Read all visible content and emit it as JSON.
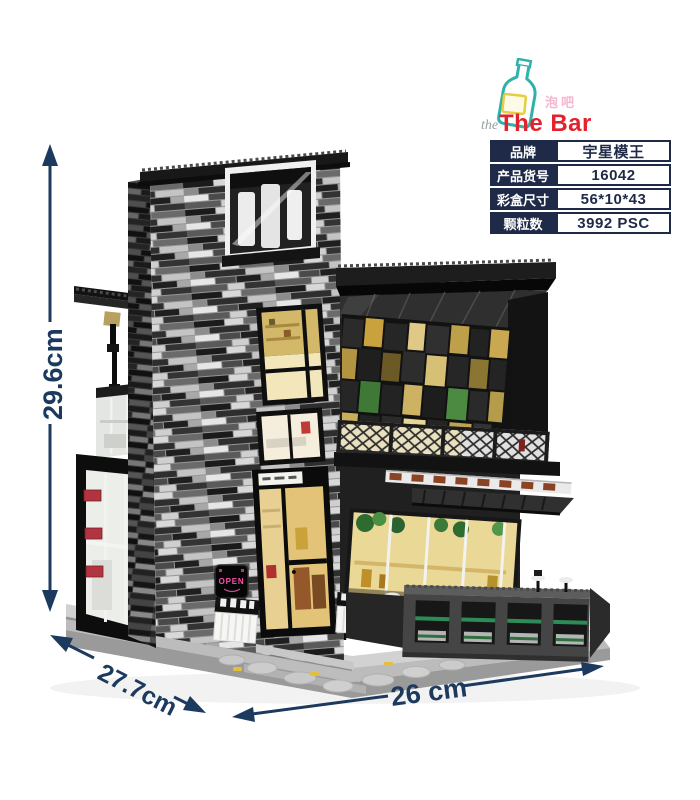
{
  "colors": {
    "navy": "#1b3a5e",
    "table_navy": "#1e2a47",
    "red": "#e2232e",
    "teal": "#2fb3a9",
    "yellow": "#e4cf3e",
    "pink": "#f2aac6",
    "neon": "#ff4fae",
    "green": "#2e8b57",
    "hinge": "#b03540",
    "warm": "#ead897"
  },
  "logo": {
    "brand": "The Bar",
    "brand_cn": "泡吧",
    "flourish": "the"
  },
  "spec_table": {
    "rows": [
      {
        "label": "品牌",
        "value": "宇星模王"
      },
      {
        "label": "产品货号",
        "value": "16042"
      },
      {
        "label": "彩盒尺寸",
        "value": "56*10*43"
      },
      {
        "label": "颗粒数",
        "value": "3992 PSC"
      }
    ]
  },
  "dimensions": {
    "height": "29.6cm",
    "depth": "27.7cm",
    "width": "26 cm"
  },
  "building": {
    "neon_sign": "OPEN"
  }
}
